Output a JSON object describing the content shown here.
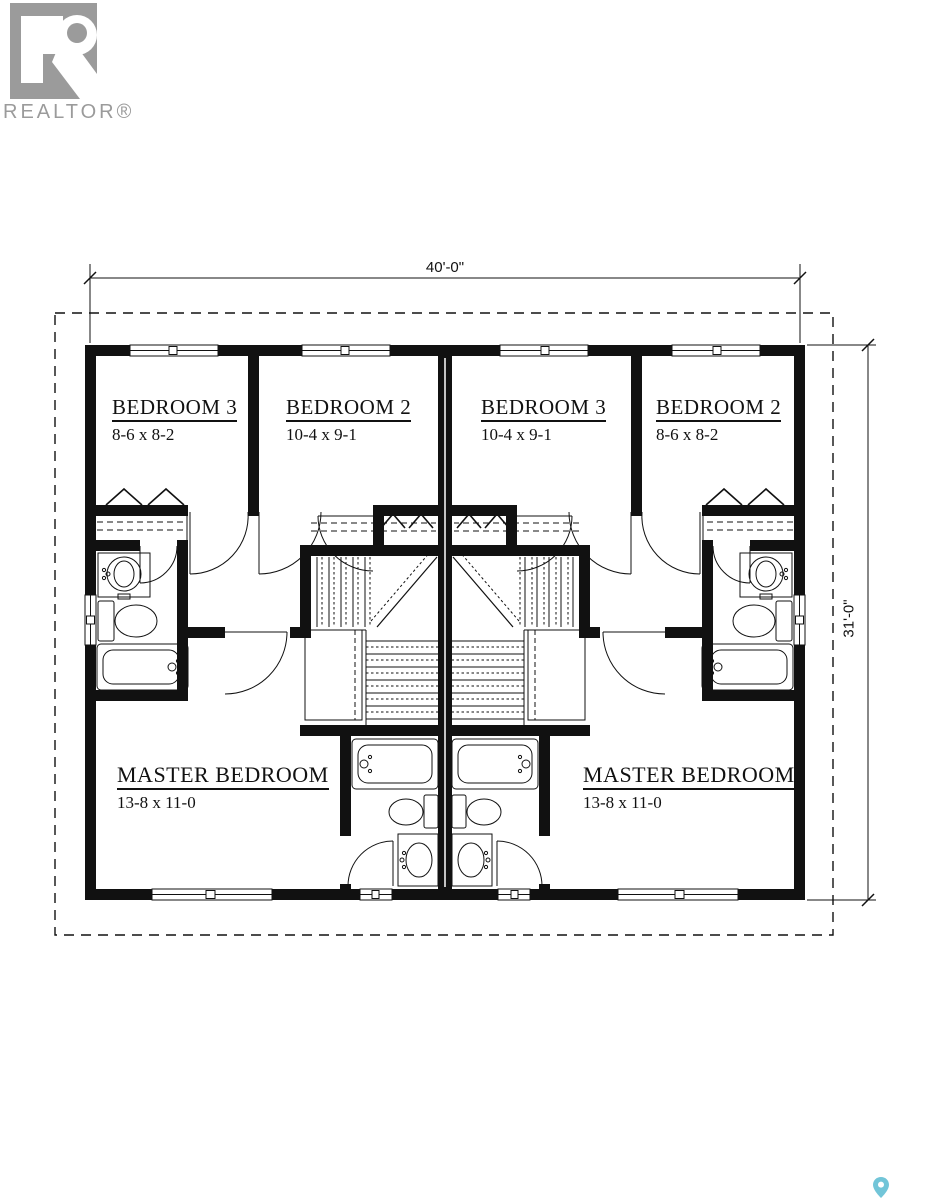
{
  "logo": {
    "text": "REALTOR®"
  },
  "dimensions": {
    "width": "40'-0\"",
    "height": "31'-0\""
  },
  "rooms": {
    "bedroom3_left": {
      "name": "BEDROOM 3",
      "size": "8-6 x 8-2"
    },
    "bedroom2_left": {
      "name": "BEDROOM 2",
      "size": "10-4 x 9-1"
    },
    "bedroom3_right": {
      "name": "BEDROOM 3",
      "size": "10-4 x 9-1"
    },
    "bedroom2_right": {
      "name": "BEDROOM 2",
      "size": "8-6 x 8-2"
    },
    "master_left": {
      "name": "MASTER BEDROOM",
      "size": "13-8 x 11-0"
    },
    "master_right": {
      "name": "MASTER BEDROOM",
      "size": "13-8 x 11-0"
    }
  },
  "icons": {
    "map_pin": "map-pin",
    "realtor_logo": "realtor-r-block"
  },
  "colors": {
    "line_black": "#111111",
    "logo_gray": "#9b9b9b",
    "pin_teal": "#72c5d8",
    "background": "#ffffff"
  }
}
